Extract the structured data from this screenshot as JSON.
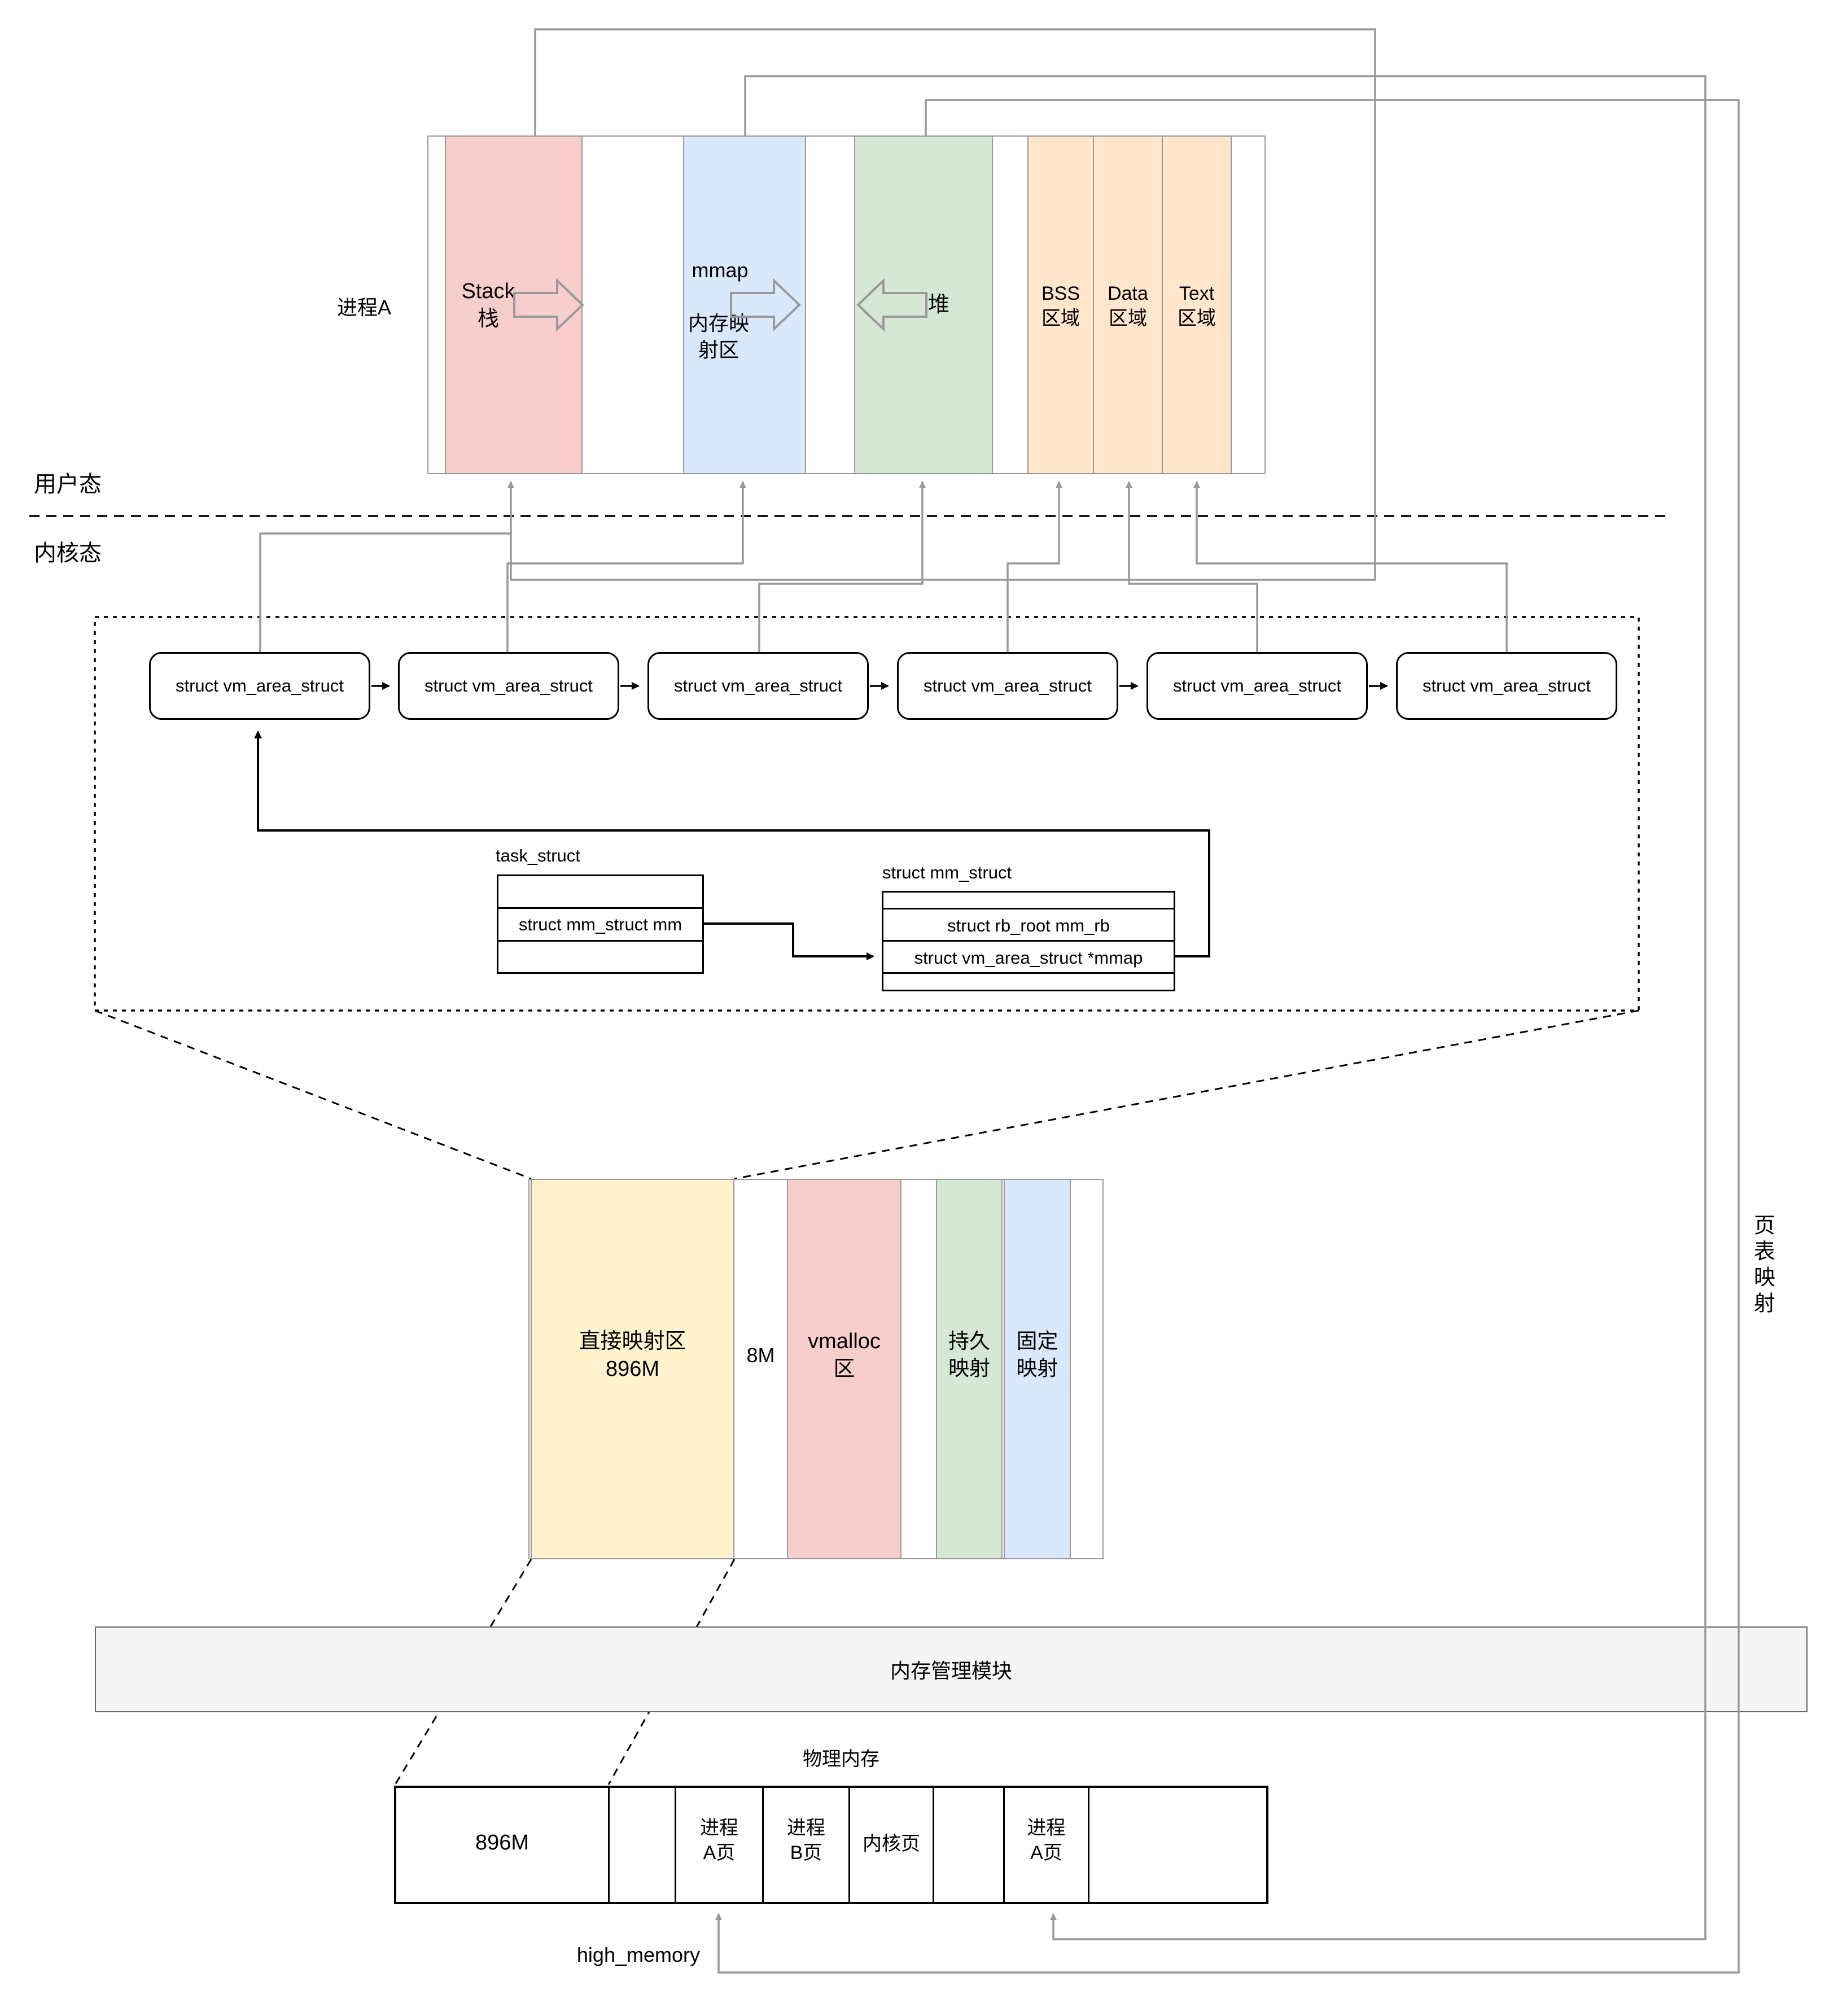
{
  "colors": {
    "pink": "#f8cecc",
    "blue": "#dae8fc",
    "green": "#d5e8d4",
    "orange": "#ffe6cc",
    "yellow": "#fff2cc",
    "line_gray": "#999999",
    "bar_fill": "#f5f5f5",
    "bar_border": "#666666"
  },
  "labels": {
    "process": "进程A",
    "user_mode": "用户态",
    "kernel_mode": "内核态",
    "page_table_mapping": "页表映射",
    "memory_module": "内存管理模块",
    "physical_memory": "物理内存",
    "high_memory": "high_memory"
  },
  "process_row": {
    "stack": "Stack\n栈",
    "mmap_title": "mmap",
    "mmap_sub": "内存映\n射区",
    "heap": "堆",
    "bss": "BSS\n区域",
    "data": "Data\n区域",
    "text": "Text\n区域"
  },
  "vma": {
    "label": "struct vm_area_struct"
  },
  "task_struct": {
    "title": "task_struct",
    "field_mm": "struct mm_struct mm"
  },
  "mm_struct": {
    "title": "struct mm_struct",
    "field_rb": "struct rb_root mm_rb",
    "field_mmap": "struct vm_area_struct *mmap"
  },
  "kernel_row": {
    "direct": "直接映射区\n896M",
    "gap_8m": "8M",
    "vmalloc": "vmalloc\n区",
    "persistent": "持久\n映射",
    "fixed": "固定\n映射"
  },
  "physical_row": {
    "cells": [
      "896M",
      "",
      "进程\nA页",
      "进程\nB页",
      "内核页",
      "",
      "进程\nA页",
      ""
    ]
  }
}
